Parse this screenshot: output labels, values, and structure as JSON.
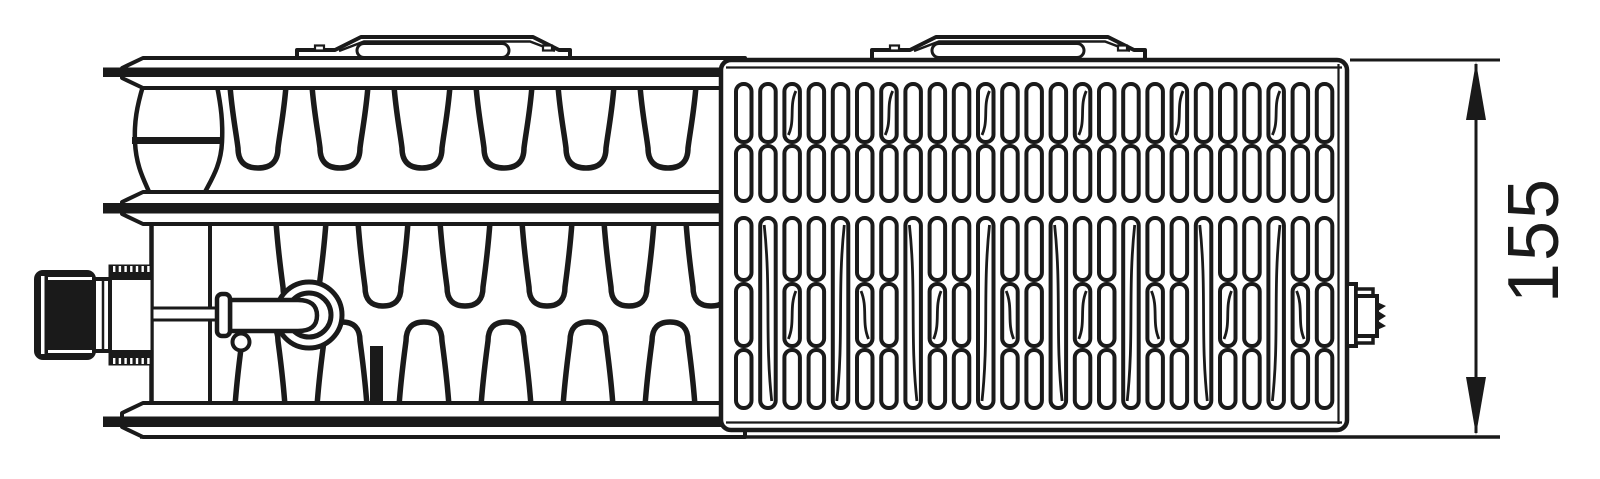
{
  "diagram": {
    "dimension": {
      "label": "155"
    },
    "colors": {
      "line": "#1a1a1a",
      "background": "#ffffff"
    }
  },
  "pattern": {
    "fins": {
      "upper_count": 6,
      "lower_pairs": 6
    },
    "grille": {
      "columns": 25,
      "upper_rows": 2,
      "lower_rows": 3
    },
    "tabs": {
      "count": 2
    }
  }
}
